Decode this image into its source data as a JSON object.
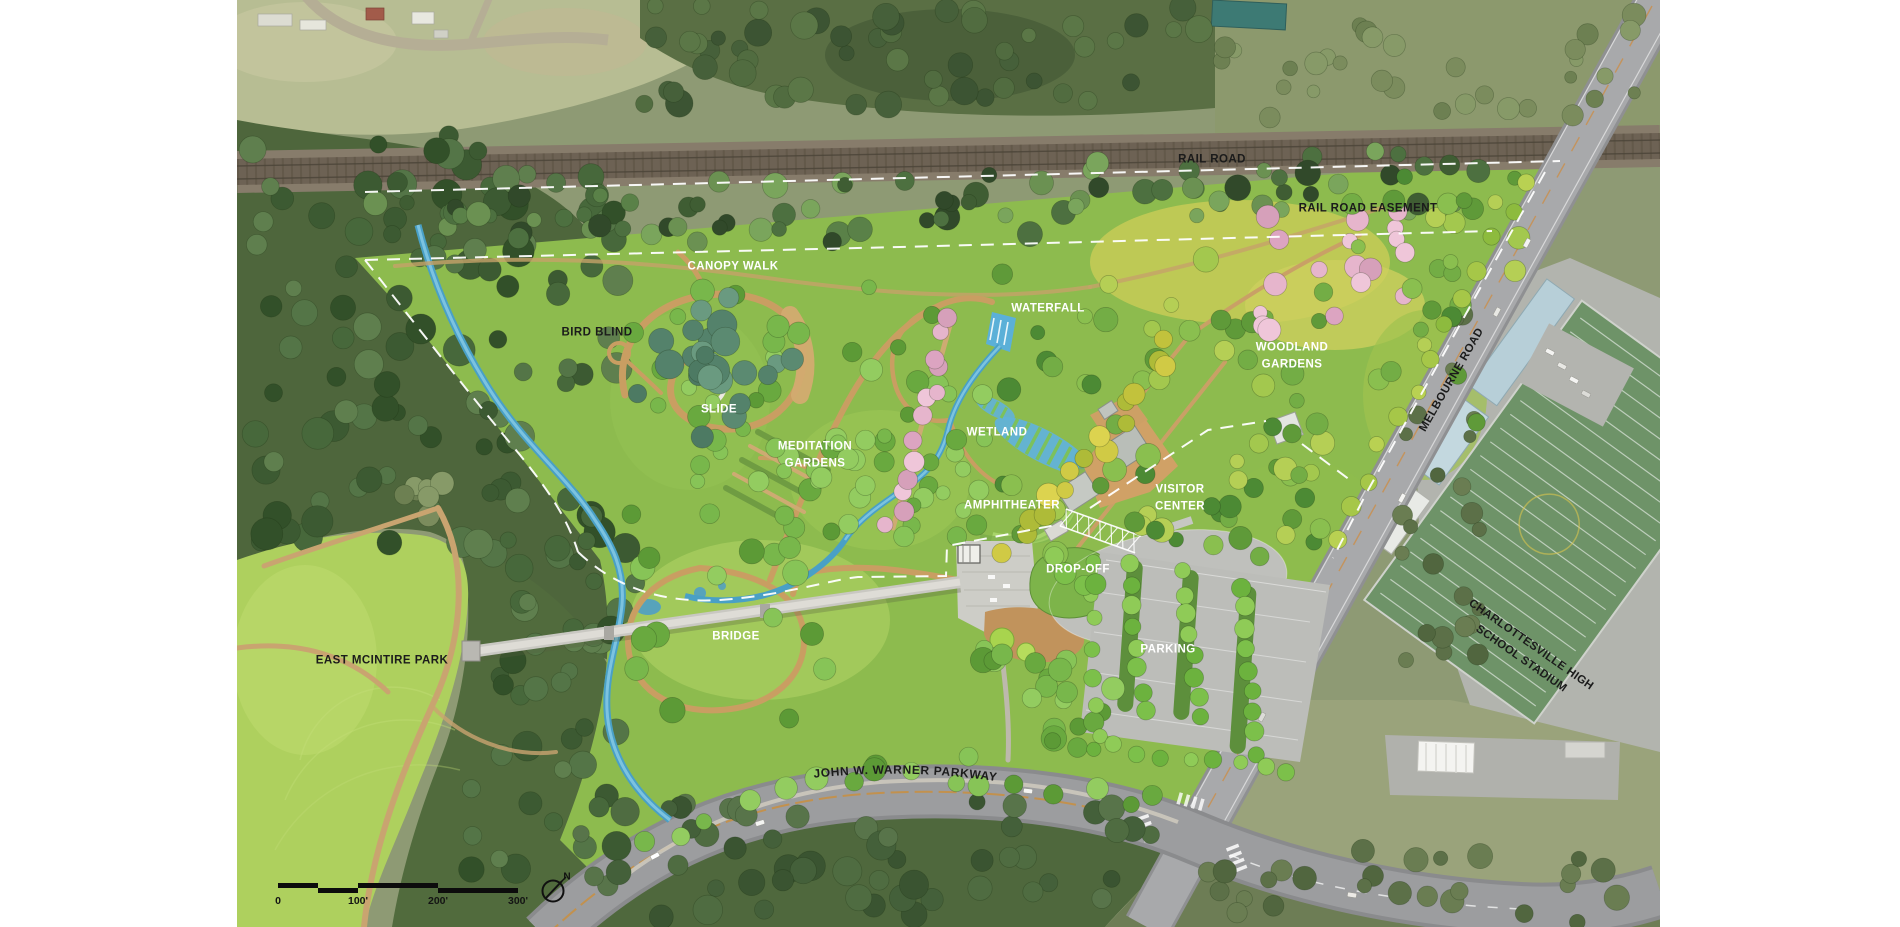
{
  "map": {
    "labels": {
      "rail_road": "RAIL ROAD",
      "rail_road_easement": "RAIL ROAD EASEMENT",
      "canopy_walk": "CANOPY WALK",
      "bird_blind": "BIRD BLIND",
      "slide": "SLIDE",
      "waterfall": "WATERFALL",
      "woodland_gardens": "WOODLAND\nGARDENS",
      "wetland": "WETLAND",
      "meditation_gardens": "MEDITATION\nGARDENS",
      "amphitheater": "AMPHITHEATER",
      "visitor_center": "VISITOR\nCENTER",
      "drop_off": "DROP-OFF",
      "parking": "PARKING",
      "bridge": "BRIDGE",
      "east_mcintire_park": "EAST MCINTIRE PARK",
      "john_w_warner_parkway": "JOHN W. WARNER PARKWAY",
      "melbourne_road": "MELBOURNE ROAD",
      "chs_stadium": "CHARLOTTESVILLE HIGH\nSCHOOL STADIUM"
    },
    "scale_bar": {
      "ticks": [
        "0",
        "100'",
        "200'",
        "300'"
      ]
    },
    "compass": {
      "north": "N"
    },
    "palette": {
      "garden_green": "#8dbb4e",
      "context_olive": "#8e9a74",
      "lawn_green": "#aed05e",
      "water_blue": "#49a0c6",
      "path_tan": "#c99e62",
      "road_gray": "#a8a9ab",
      "cherry_pink": "#e6b5cc",
      "label_white": "#ffffff",
      "label_black": "#1b1b1b"
    }
  }
}
